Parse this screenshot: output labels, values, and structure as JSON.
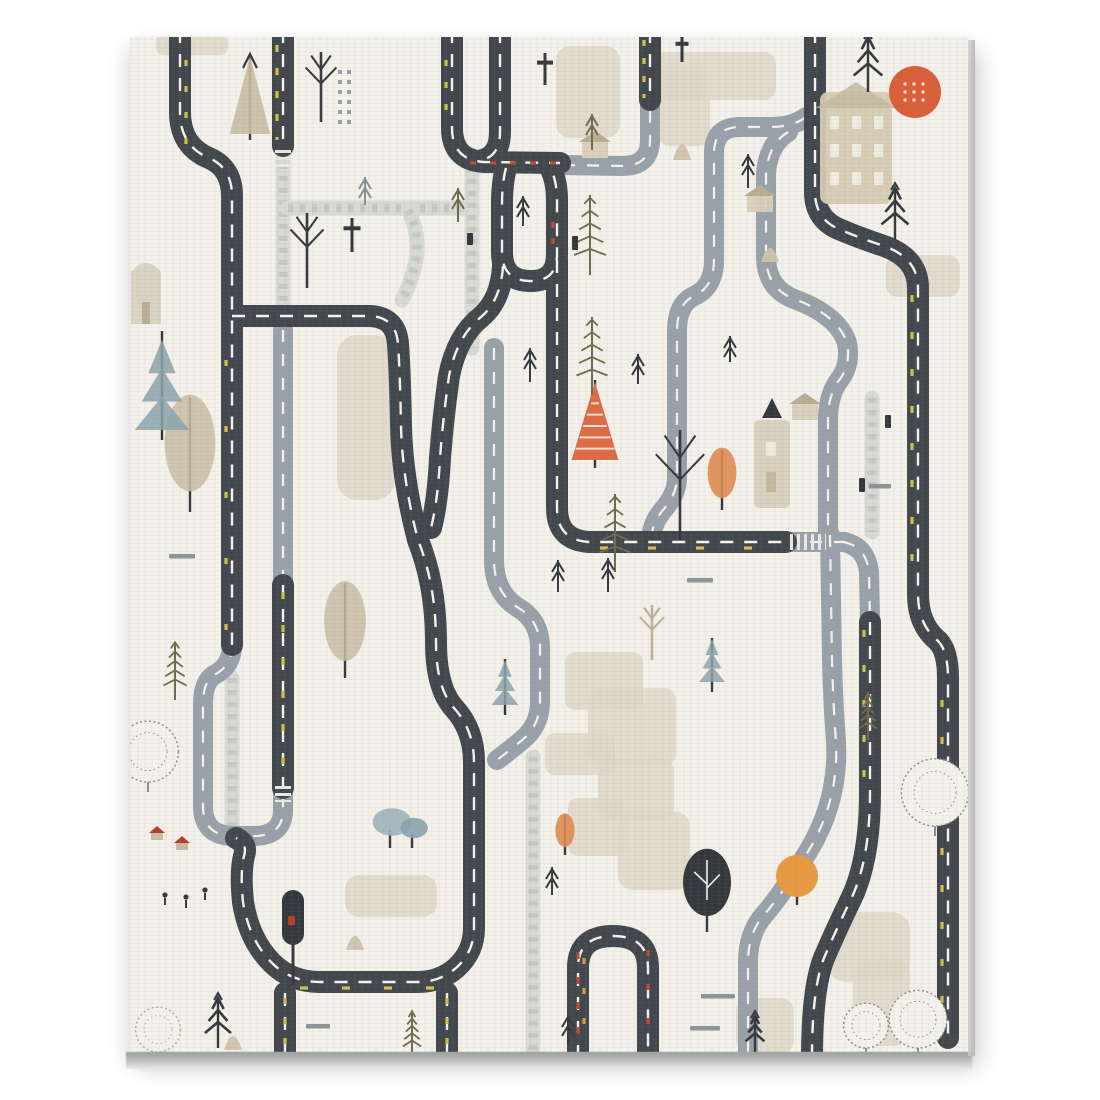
{
  "meta": {
    "title": "Scandinavian road-map play mat canvas print",
    "kind": "decorative artwork, no text"
  },
  "palette": {
    "page": "#ffffff",
    "background": "#f3f1ea",
    "road_dark": "#42474d",
    "road_gray": "#99a2aa",
    "cobble": "#d9dad5",
    "cobble_brick": "#c2c4be",
    "dash_white": "#f5f4ef",
    "dash_yellow": "#cdc14a",
    "dash_red": "#bf4b33",
    "dash_orange": "#d79a3c",
    "patch_beige": "#ded7c7",
    "tree_tan": "#c9bda4",
    "tree_blue": "#8ba3ad",
    "tree_olive": "#6f6b50",
    "tree_orange": "#dd6b45",
    "tree_orange_light": "#e08952",
    "round_orange": "#e89b41",
    "sun": "#d95f38",
    "ink": "#34383d",
    "sketch": "#8a8f8f",
    "canvas_edge": "#b2b4b6"
  },
  "frame": {
    "x": 130,
    "y": 37,
    "w": 838,
    "h": 1015
  },
  "roads_dark": [
    {
      "id": "d1-topleft-s",
      "d": "M 180 30 L 180 112 Q 180 146 209 158 Q 232 168 232 196 L 232 645"
    },
    {
      "id": "d3-left-loop",
      "d": "M 232 316 L 368 316 Q 396 316 398 344 Q 400 372 401 425 Q 402 478 418 540 Q 436 585 436 642 Q 436 688 454 708 Q 474 730 474 762 L 474 928 Q 474 952 456 968 Q 440 982 418 982 L 320 982 Q 291 982 272 963 Q 249 940 243 902 Q 240 872 244 856 Q 248 844 236 838"
    },
    {
      "id": "d4-u-left-arm",
      "d": "M 452 30 L 452 128 Q 452 160 484 162 L 560 163"
    },
    {
      "id": "d5-u-right-arm",
      "d": "M 500 30 L 500 132 Q 500 158 478 161"
    },
    {
      "id": "d6-oval",
      "d": "M 506 168 Q 502 182 502 205 L 502 252 Q 502 280 529 281 Q 557 282 557 254 L 557 200 Q 557 182 551 169"
    },
    {
      "id": "d7-center-horizontal",
      "d": "M 557 260 L 557 508 Q 557 540 589 542 L 786 542"
    },
    {
      "id": "d8-oval-tail",
      "d": "M 503 266 Q 501 300 481 317 Q 457 336 449 376 Q 443 418 440 458 Q 438 500 431 528"
    },
    {
      "id": "d9-arch",
      "d": "M 578 1058 L 578 968 Q 578 936 613 936 Q 648 936 648 968 L 648 1058"
    },
    {
      "id": "d10-leg-left",
      "d": "M 285 993 L 285 1058"
    },
    {
      "id": "d10b-leg-right",
      "d": "M 447 993 L 447 1058"
    },
    {
      "id": "d12-right-s-down",
      "d": "M 870 622 L 870 792 Q 870 858 852 897 Q 836 930 824 958 Q 812 988 812 1058"
    },
    {
      "id": "d13-rightmost",
      "d": "M 815 30 L 815 192 Q 815 220 841 230 Q 860 238 884 246 Q 918 258 918 288 L 918 594 Q 918 624 937 640 Q 948 650 948 678 L 948 1038"
    },
    {
      "id": "d14-top-stub",
      "d": "M 650 30 L 650 100"
    },
    {
      "id": "d15a-mid-stub-top",
      "d": "M 283 30 L 283 146"
    },
    {
      "id": "d15b-mid-segment",
      "d": "M 283 585 L 283 788"
    }
  ],
  "roads_gray": [
    {
      "id": "gu-left-u",
      "d": "M 232 645 Q 232 666 214 675 Q 203 682 203 704 L 203 806 Q 203 835 232 836 L 253 836 Q 283 836 283 810 L 283 792"
    },
    {
      "id": "g1-mid-vertical",
      "d": "M 283 330 L 283 585"
    },
    {
      "id": "g2-top-elbow",
      "d": "M 563 165 L 622 166 Q 650 166 650 140 L 650 100"
    },
    {
      "id": "g3-question-loop",
      "d": "M 806 117 Q 793 127 770 127 L 740 127 Q 714 127 714 153 L 714 260 Q 714 287 694 296 Q 677 304 677 331 L 677 478 Q 677 494 663 510 Q 651 524 651 542"
    },
    {
      "id": "g4-right-s",
      "d": "M 788 132 Q 768 144 766 174 L 766 256 Q 766 288 794 299 Q 838 315 847 343 Q 851 364 840 379 Q 828 394 828 420 L 828 532"
    },
    {
      "id": "g5-right-down",
      "d": "M 830 535 L 832 660 Q 833 702 836 742 Q 839 800 809 850 Q 781 896 763 916 Q 748 934 748 962 L 748 1058"
    },
    {
      "id": "g6-junction-arm",
      "d": "M 843 542 Q 866 546 869 572 L 870 622"
    },
    {
      "id": "g7-horizontal-gray",
      "d": "M 786 542 L 845 542"
    },
    {
      "id": "g8-center-s",
      "d": "M 494 348 L 494 560 Q 494 592 517 607 Q 540 620 540 648 L 540 702 Q 540 726 521 741 Q 505 754 497 760"
    }
  ],
  "paths_cobble": [
    {
      "id": "c1",
      "d": "M 283 152 L 283 302"
    },
    {
      "id": "c2",
      "d": "M 288 208 L 464 208"
    },
    {
      "id": "c3",
      "d": "M 472 155 L 472 348"
    },
    {
      "id": "c4",
      "d": "M 408 210 Q 420 232 416 260 Q 411 284 402 300"
    },
    {
      "id": "c5",
      "d": "M 533 757 L 533 1052"
    },
    {
      "id": "c6",
      "d": "M 872 398 L 872 532"
    },
    {
      "id": "c7",
      "d": "M 232 678 L 232 828"
    }
  ],
  "accents": [
    {
      "id": "a1",
      "d": "M 277 45 L 277 140",
      "color": "dash_yellow",
      "dash": "7 16"
    },
    {
      "id": "a2",
      "d": "M 283 592 L 283 780",
      "color": "dash_yellow",
      "dash": "7 26"
    },
    {
      "id": "a3",
      "d": "M 470 163 L 558 163",
      "color": "dash_red",
      "dash": "6 14"
    },
    {
      "id": "a4",
      "d": "M 553 222 L 553 246",
      "color": "dash_red",
      "dash": "6 10"
    },
    {
      "id": "a5",
      "d": "M 912 295 L 912 590",
      "color": "dash_yellow",
      "dash": "7 30"
    },
    {
      "id": "a6",
      "d": "M 644 40 L 644 98",
      "color": "dash_yellow",
      "dash": "6 12"
    },
    {
      "id": "a7",
      "d": "M 864 630 L 864 780",
      "color": "dash_yellow",
      "dash": "7 28"
    },
    {
      "id": "a8",
      "d": "M 300 988 L 440 988",
      "color": "dash_yellow",
      "dash": "8 34"
    },
    {
      "id": "a9",
      "d": "M 600 548 L 770 548",
      "color": "dash_yellow",
      "dash": "8 40"
    },
    {
      "id": "a10",
      "d": "M 578 952 L 578 1048",
      "color": "dash_red",
      "dash": "7 18"
    },
    {
      "id": "a11",
      "d": "M 584 958 L 584 1045",
      "color": "dash_orange",
      "dash": "6 24"
    },
    {
      "id": "a12",
      "d": "M 648 950 L 648 1048",
      "color": "dash_red",
      "dash": "6 28"
    },
    {
      "id": "a13",
      "d": "M 285 998 L 285 1048",
      "color": "dash_yellow",
      "dash": "6 14"
    },
    {
      "id": "a13b",
      "d": "M 447 998 L 447 1048",
      "color": "dash_yellow",
      "dash": "6 14"
    },
    {
      "id": "a14",
      "d": "M 186 60 L 186 150",
      "color": "dash_yellow",
      "dash": "6 20"
    },
    {
      "id": "a15",
      "d": "M 226 360 L 226 630",
      "color": "dash_yellow",
      "dash": "6 60"
    },
    {
      "id": "a16",
      "d": "M 942 700 L 942 1030",
      "color": "dash_yellow",
      "dash": "7 30"
    },
    {
      "id": "a17",
      "d": "M 446 60 L 446 120",
      "color": "dash_yellow",
      "dash": "6 16"
    }
  ],
  "crosswalks": [
    {
      "x1": 283,
      "y1": 150,
      "x2": 283,
      "y2": 168
    },
    {
      "x1": 283,
      "y1": 786,
      "x2": 283,
      "y2": 802
    },
    {
      "x1": 790,
      "y1": 542,
      "x2": 826,
      "y2": 542
    }
  ],
  "patches": [
    {
      "x": 337,
      "y": 335,
      "w": 58,
      "h": 165,
      "r": 20
    },
    {
      "x": 556,
      "y": 46,
      "w": 64,
      "h": 92,
      "r": 14
    },
    {
      "x": 652,
      "y": 52,
      "w": 124,
      "h": 48,
      "r": 12
    },
    {
      "x": 658,
      "y": 68,
      "w": 52,
      "h": 78,
      "r": 12
    },
    {
      "x": 886,
      "y": 255,
      "w": 74,
      "h": 42,
      "r": 12
    },
    {
      "x": 565,
      "y": 652,
      "w": 78,
      "h": 58,
      "r": 10
    },
    {
      "x": 588,
      "y": 688,
      "w": 88,
      "h": 78,
      "r": 12
    },
    {
      "x": 545,
      "y": 733,
      "w": 70,
      "h": 42,
      "r": 10
    },
    {
      "x": 598,
      "y": 758,
      "w": 76,
      "h": 62,
      "r": 12
    },
    {
      "x": 568,
      "y": 798,
      "w": 58,
      "h": 58,
      "r": 10
    },
    {
      "x": 618,
      "y": 812,
      "w": 72,
      "h": 78,
      "r": 14
    },
    {
      "x": 345,
      "y": 875,
      "w": 92,
      "h": 42,
      "r": 14
    },
    {
      "x": 828,
      "y": 912,
      "w": 82,
      "h": 70,
      "r": 18
    },
    {
      "x": 853,
      "y": 958,
      "w": 57,
      "h": 88,
      "r": 16
    },
    {
      "x": 736,
      "y": 998,
      "w": 58,
      "h": 56,
      "r": 14
    },
    {
      "x": 156,
      "y": 33,
      "w": 72,
      "h": 22,
      "r": 8
    }
  ],
  "buildings": [
    {
      "type": "bighouse",
      "x": 820,
      "y": 92,
      "w": 72,
      "h": 112
    },
    {
      "type": "tower",
      "x": 754,
      "y": 420,
      "w": 36,
      "h": 88
    },
    {
      "type": "house",
      "x": 595,
      "y": 158
    },
    {
      "type": "house",
      "x": 805,
      "y": 420
    },
    {
      "type": "house",
      "x": 760,
      "y": 212
    },
    {
      "type": "hut_arch",
      "x": 146,
      "y": 292
    },
    {
      "type": "hut_red",
      "x": 157,
      "y": 840
    },
    {
      "type": "hut_red",
      "x": 182,
      "y": 850
    }
  ],
  "trees": [
    {
      "type": "sun",
      "x": 915,
      "y": 92,
      "s": 26
    },
    {
      "type": "round_orange",
      "x": 797,
      "y": 905,
      "s": 21
    },
    {
      "type": "pine_striped",
      "x": 595,
      "y": 468,
      "s": 78
    },
    {
      "type": "poplar_orange",
      "x": 722,
      "y": 510,
      "s": 60
    },
    {
      "type": "poplar_orange",
      "x": 565,
      "y": 855,
      "s": 40
    },
    {
      "type": "pine_tan",
      "x": 250,
      "y": 140,
      "s": 78
    },
    {
      "type": "poplar_tan",
      "x": 190,
      "y": 512,
      "s": 115
    },
    {
      "type": "poplar_tan",
      "x": 345,
      "y": 678,
      "s": 95
    },
    {
      "type": "pine_blue",
      "x": 162,
      "y": 440,
      "s": 105
    },
    {
      "type": "pine_blue",
      "x": 505,
      "y": 715,
      "s": 52
    },
    {
      "type": "pine_blue",
      "x": 712,
      "y": 692,
      "s": 50
    },
    {
      "type": "pine_dark",
      "x": 868,
      "y": 92,
      "s": 55
    },
    {
      "type": "pine_dark",
      "x": 895,
      "y": 240,
      "s": 52
    },
    {
      "type": "pine_dark",
      "x": 218,
      "y": 1048,
      "s": 50
    },
    {
      "type": "pine_dark",
      "x": 755,
      "y": 1052,
      "s": 36
    },
    {
      "type": "pine_sparse",
      "x": 590,
      "y": 275,
      "s": 80
    },
    {
      "type": "pine_sparse",
      "x": 592,
      "y": 395,
      "s": 78
    },
    {
      "type": "pine_sparse",
      "x": 615,
      "y": 572,
      "s": 78
    },
    {
      "type": "pine_sparse",
      "x": 175,
      "y": 700,
      "s": 58
    },
    {
      "type": "pine_sparse",
      "x": 412,
      "y": 1058,
      "s": 46
    },
    {
      "type": "pine_sparse",
      "x": 868,
      "y": 740,
      "s": 46
    },
    {
      "type": "leafy_dark",
      "x": 707,
      "y": 932,
      "s": 80
    },
    {
      "type": "cloud_blue",
      "x": 400,
      "y": 848,
      "s": 46
    },
    {
      "type": "sketchy",
      "x": 935,
      "y": 836,
      "s": 42
    },
    {
      "type": "sketchy",
      "x": 918,
      "y": 1058,
      "s": 36
    },
    {
      "type": "sketchy",
      "x": 866,
      "y": 1058,
      "s": 28
    },
    {
      "type": "sketchy",
      "x": 148,
      "y": 792,
      "s": 38
    },
    {
      "type": "sketchy_tan",
      "x": 158,
      "y": 1062,
      "s": 28
    },
    {
      "type": "bare",
      "x": 680,
      "y": 540,
      "s": 110
    },
    {
      "type": "bare",
      "x": 321,
      "y": 122,
      "s": 70
    },
    {
      "type": "bare",
      "x": 307,
      "y": 288,
      "s": 75
    },
    {
      "type": "bare_tan",
      "x": 652,
      "y": 660,
      "s": 55
    },
    {
      "type": "mailbox",
      "x": 293,
      "y": 985,
      "s": 95
    },
    {
      "type": "arrow",
      "x": 458,
      "y": 222,
      "s": 34,
      "c": "tree_olive"
    },
    {
      "type": "arrow",
      "x": 523,
      "y": 226,
      "s": 30
    },
    {
      "type": "arrow",
      "x": 530,
      "y": 382,
      "s": 34
    },
    {
      "type": "arrow",
      "x": 558,
      "y": 592,
      "s": 32
    },
    {
      "type": "arrow",
      "x": 608,
      "y": 592,
      "s": 34
    },
    {
      "type": "arrow",
      "x": 638,
      "y": 384,
      "s": 30
    },
    {
      "type": "arrow",
      "x": 748,
      "y": 188,
      "s": 34
    },
    {
      "type": "arrow",
      "x": 730,
      "y": 362,
      "s": 26
    },
    {
      "type": "arrow",
      "x": 592,
      "y": 150,
      "s": 36,
      "c": "tree_olive"
    },
    {
      "type": "arrow",
      "x": 365,
      "y": 205,
      "s": 28,
      "c": "sketch"
    },
    {
      "type": "arrow",
      "x": 552,
      "y": 895,
      "s": 28
    },
    {
      "type": "arrow",
      "x": 568,
      "y": 1045,
      "s": 30
    },
    {
      "type": "cross",
      "x": 545,
      "y": 85,
      "s": 32
    },
    {
      "type": "cross",
      "x": 352,
      "y": 252,
      "s": 34
    },
    {
      "type": "cross",
      "x": 682,
      "y": 62,
      "s": 26
    },
    {
      "type": "cone",
      "x": 682,
      "y": 160,
      "s": 26
    },
    {
      "type": "cone",
      "x": 233,
      "y": 1050,
      "s": 22
    },
    {
      "type": "cone",
      "x": 355,
      "y": 950,
      "s": 22
    },
    {
      "type": "cone",
      "x": 770,
      "y": 262,
      "s": 22
    },
    {
      "type": "bar",
      "x": 182,
      "y": 556,
      "s": 26
    },
    {
      "type": "bar",
      "x": 700,
      "y": 580,
      "s": 26
    },
    {
      "type": "bar",
      "x": 718,
      "y": 996,
      "s": 34
    },
    {
      "type": "bar",
      "x": 705,
      "y": 1028,
      "s": 30
    },
    {
      "type": "bar",
      "x": 318,
      "y": 1026,
      "s": 24
    },
    {
      "type": "bar",
      "x": 880,
      "y": 486,
      "s": 22
    },
    {
      "type": "tick",
      "x": 575,
      "y": 250,
      "s": 14
    },
    {
      "type": "tick",
      "x": 862,
      "y": 492,
      "s": 14
    },
    {
      "type": "tick",
      "x": 888,
      "y": 428,
      "s": 13
    },
    {
      "type": "tick",
      "x": 470,
      "y": 245,
      "s": 12
    },
    {
      "type": "dotcol",
      "x": 338,
      "y": 130,
      "s": 60
    },
    {
      "type": "figure",
      "x": 165,
      "y": 905,
      "s": 10
    },
    {
      "type": "figure",
      "x": 186,
      "y": 908,
      "s": 11
    },
    {
      "type": "figure",
      "x": 205,
      "y": 900,
      "s": 10
    }
  ],
  "road_style": {
    "dark_width": 22,
    "gray_width": 20,
    "cobble_width": 15,
    "dash_pattern_dark": "13 11",
    "dash_pattern_gray": "12 12",
    "brick_pattern": "5 7"
  }
}
